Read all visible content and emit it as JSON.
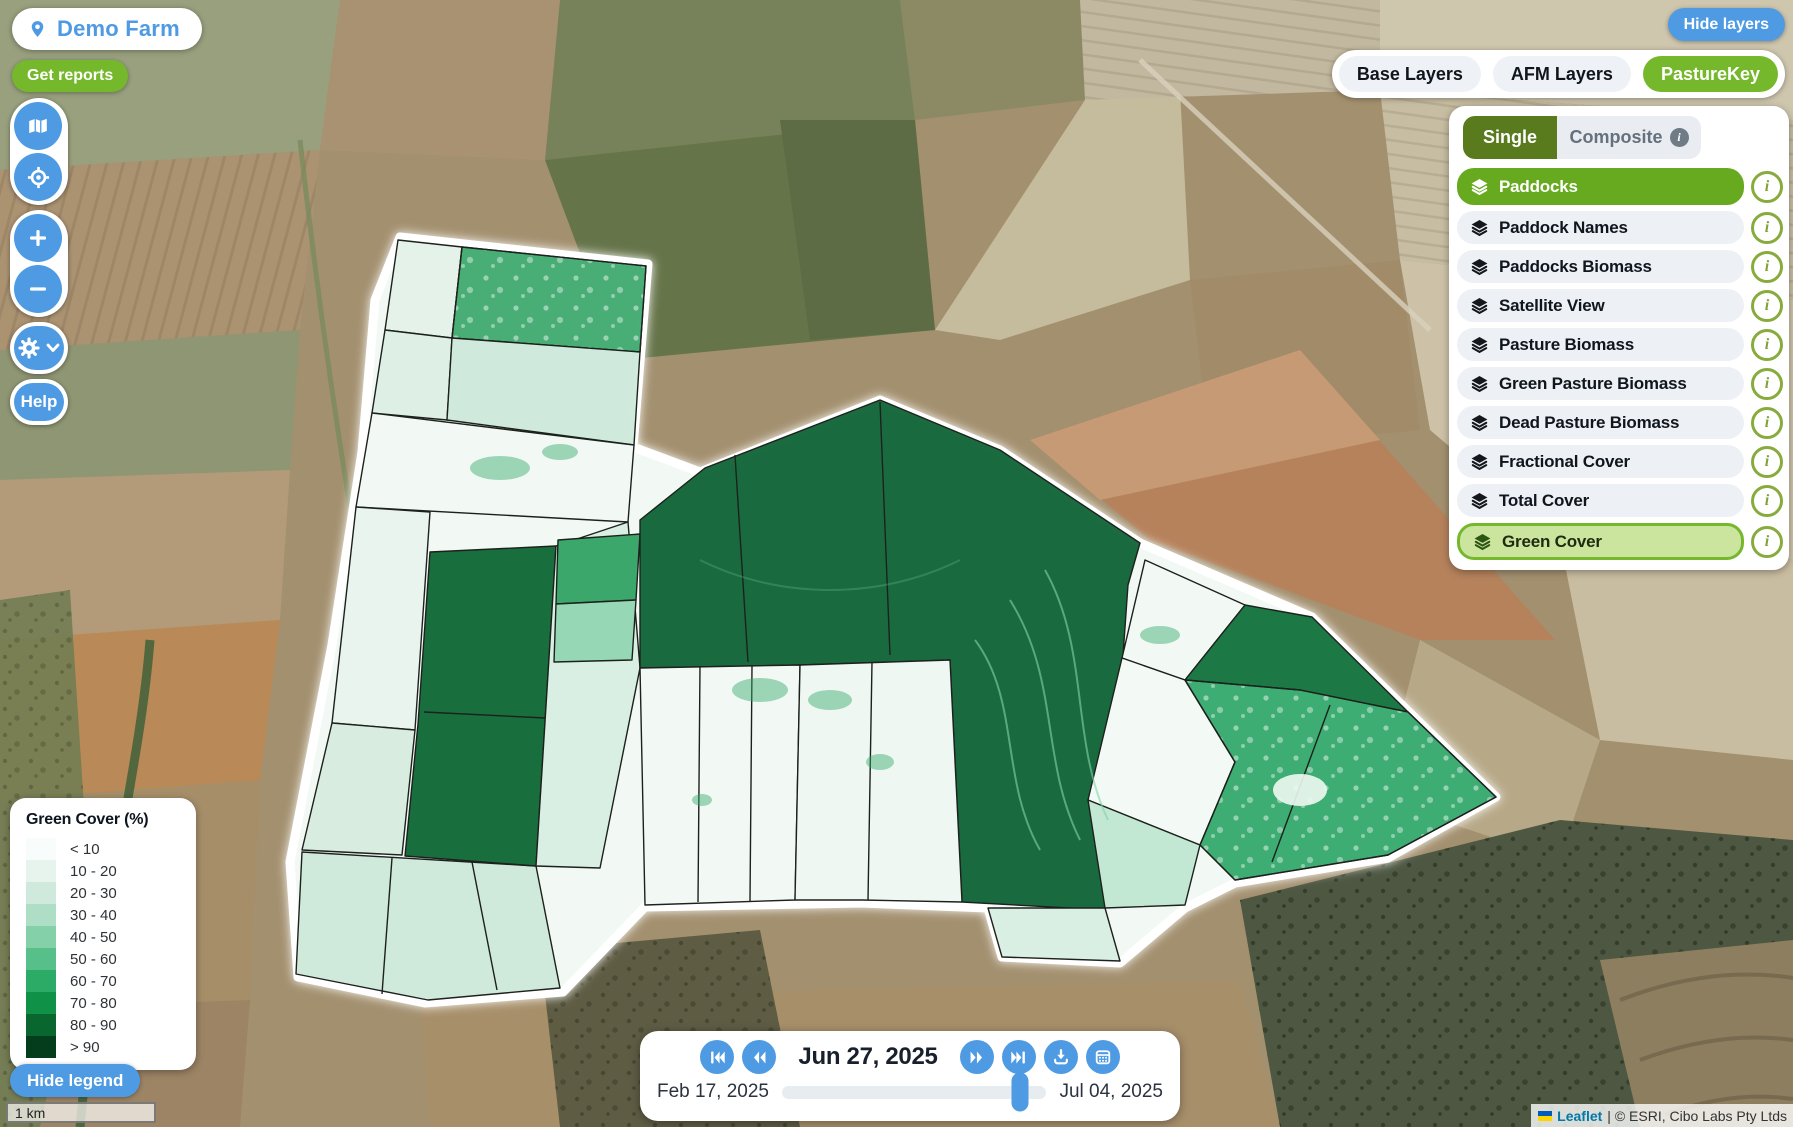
{
  "header": {
    "farm_button": "Demo Farm",
    "get_reports": "Get reports",
    "hide_layers": "Hide layers"
  },
  "map_controls": {
    "help": "Help"
  },
  "layer_tabs": [
    {
      "label": "Base Layers",
      "active": false
    },
    {
      "label": "AFM Layers",
      "active": false
    },
    {
      "label": "PastureKey",
      "active": true
    }
  ],
  "mode_toggle": {
    "single_label": "Single",
    "composite_label": "Composite",
    "active": "Single"
  },
  "layers": [
    {
      "label": "Paddocks",
      "state": "selected-solid"
    },
    {
      "label": "Paddock Names",
      "state": "default"
    },
    {
      "label": "Paddocks Biomass",
      "state": "default"
    },
    {
      "label": "Satellite View",
      "state": "default"
    },
    {
      "label": "Pasture Biomass",
      "state": "default"
    },
    {
      "label": "Green Pasture Biomass",
      "state": "default"
    },
    {
      "label": "Dead Pasture Biomass",
      "state": "default"
    },
    {
      "label": "Fractional Cover",
      "state": "default"
    },
    {
      "label": "Total Cover",
      "state": "default"
    },
    {
      "label": "Green Cover",
      "state": "selected-outline"
    }
  ],
  "legend": {
    "title": "Green Cover (%)",
    "hide_label": "Hide legend",
    "entries": [
      {
        "label": "< 10",
        "color": "#f8fcfa"
      },
      {
        "label": "10 - 20",
        "color": "#e7f4ee"
      },
      {
        "label": "20 - 30",
        "color": "#cfeadd"
      },
      {
        "label": "30 - 40",
        "color": "#aedec6"
      },
      {
        "label": "40 - 50",
        "color": "#84d0a9"
      },
      {
        "label": "50 - 60",
        "color": "#56bf8a"
      },
      {
        "label": "60 - 70",
        "color": "#2cab66"
      },
      {
        "label": "70 - 80",
        "color": "#0f9147"
      },
      {
        "label": "80 - 90",
        "color": "#09662f"
      },
      {
        "label": "> 90",
        "color": "#043d1c"
      }
    ]
  },
  "timeline": {
    "current_date": "Jun 27, 2025",
    "range_start": "Feb 17, 2025",
    "range_end": "Jul 04, 2025",
    "slider_position_pct": 90
  },
  "scale_bar": {
    "label": "1 km"
  },
  "attribution": {
    "library": "Leaflet",
    "suffix": "| © ESRI, Cibo Labs Pty Ltds"
  },
  "colors": {
    "accent_blue": "#4e9be3",
    "brand_green": "#76b82c",
    "mode_active_green": "#5a7a1e",
    "layer_selected_green": "#67aa1f",
    "layer_selected_light": "#cbe49e"
  }
}
